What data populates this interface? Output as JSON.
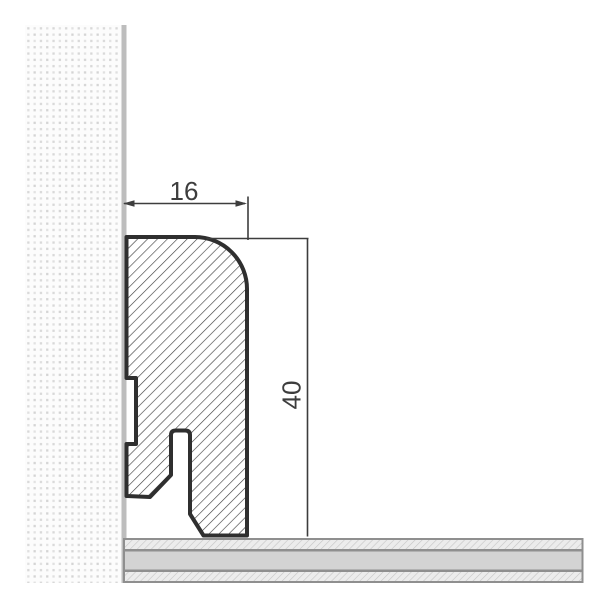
{
  "drawing": {
    "dimension_width_label": "16",
    "dimension_height_label": "40",
    "colors": {
      "profile_outline": "#2f2f2f",
      "profile_hatch": "#3d3d3d",
      "dimension_lines": "#3d3d3d",
      "wall_surface_line": "#bdbdbd",
      "wall_dot": "#dadada",
      "floor_border": "#8f8f8f",
      "floor_panel_fill": "#d3d3d3",
      "floor_underlay_fill": "#ececec"
    }
  }
}
